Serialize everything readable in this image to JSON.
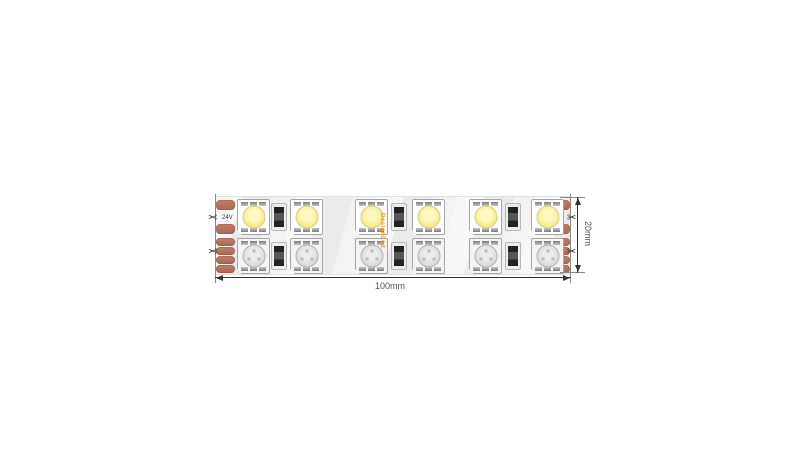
{
  "diagram": {
    "brand": "DesignLed",
    "dimensions": {
      "width_label": "100mm",
      "height_label": "20mm"
    },
    "labels": {
      "left": {
        "plus": "+",
        "voltage": "24V",
        "minus": "-",
        "channels": [
          "24V",
          "R",
          "G",
          "B"
        ]
      },
      "right": {
        "plus": "+",
        "voltage": "24V",
        "minus": "-",
        "channels": [
          "24V",
          "R",
          "G",
          "B"
        ]
      }
    },
    "icons": {
      "scissors": "✂"
    },
    "colors": {
      "pad_copper": "#b5735e",
      "white_led_lens": "#f4e87f",
      "rgb_led_lens": "#d8d8d8",
      "brand_orange": "#e2992e",
      "strip_body": "#f3f3f3",
      "dimension_text": "#555555"
    }
  }
}
